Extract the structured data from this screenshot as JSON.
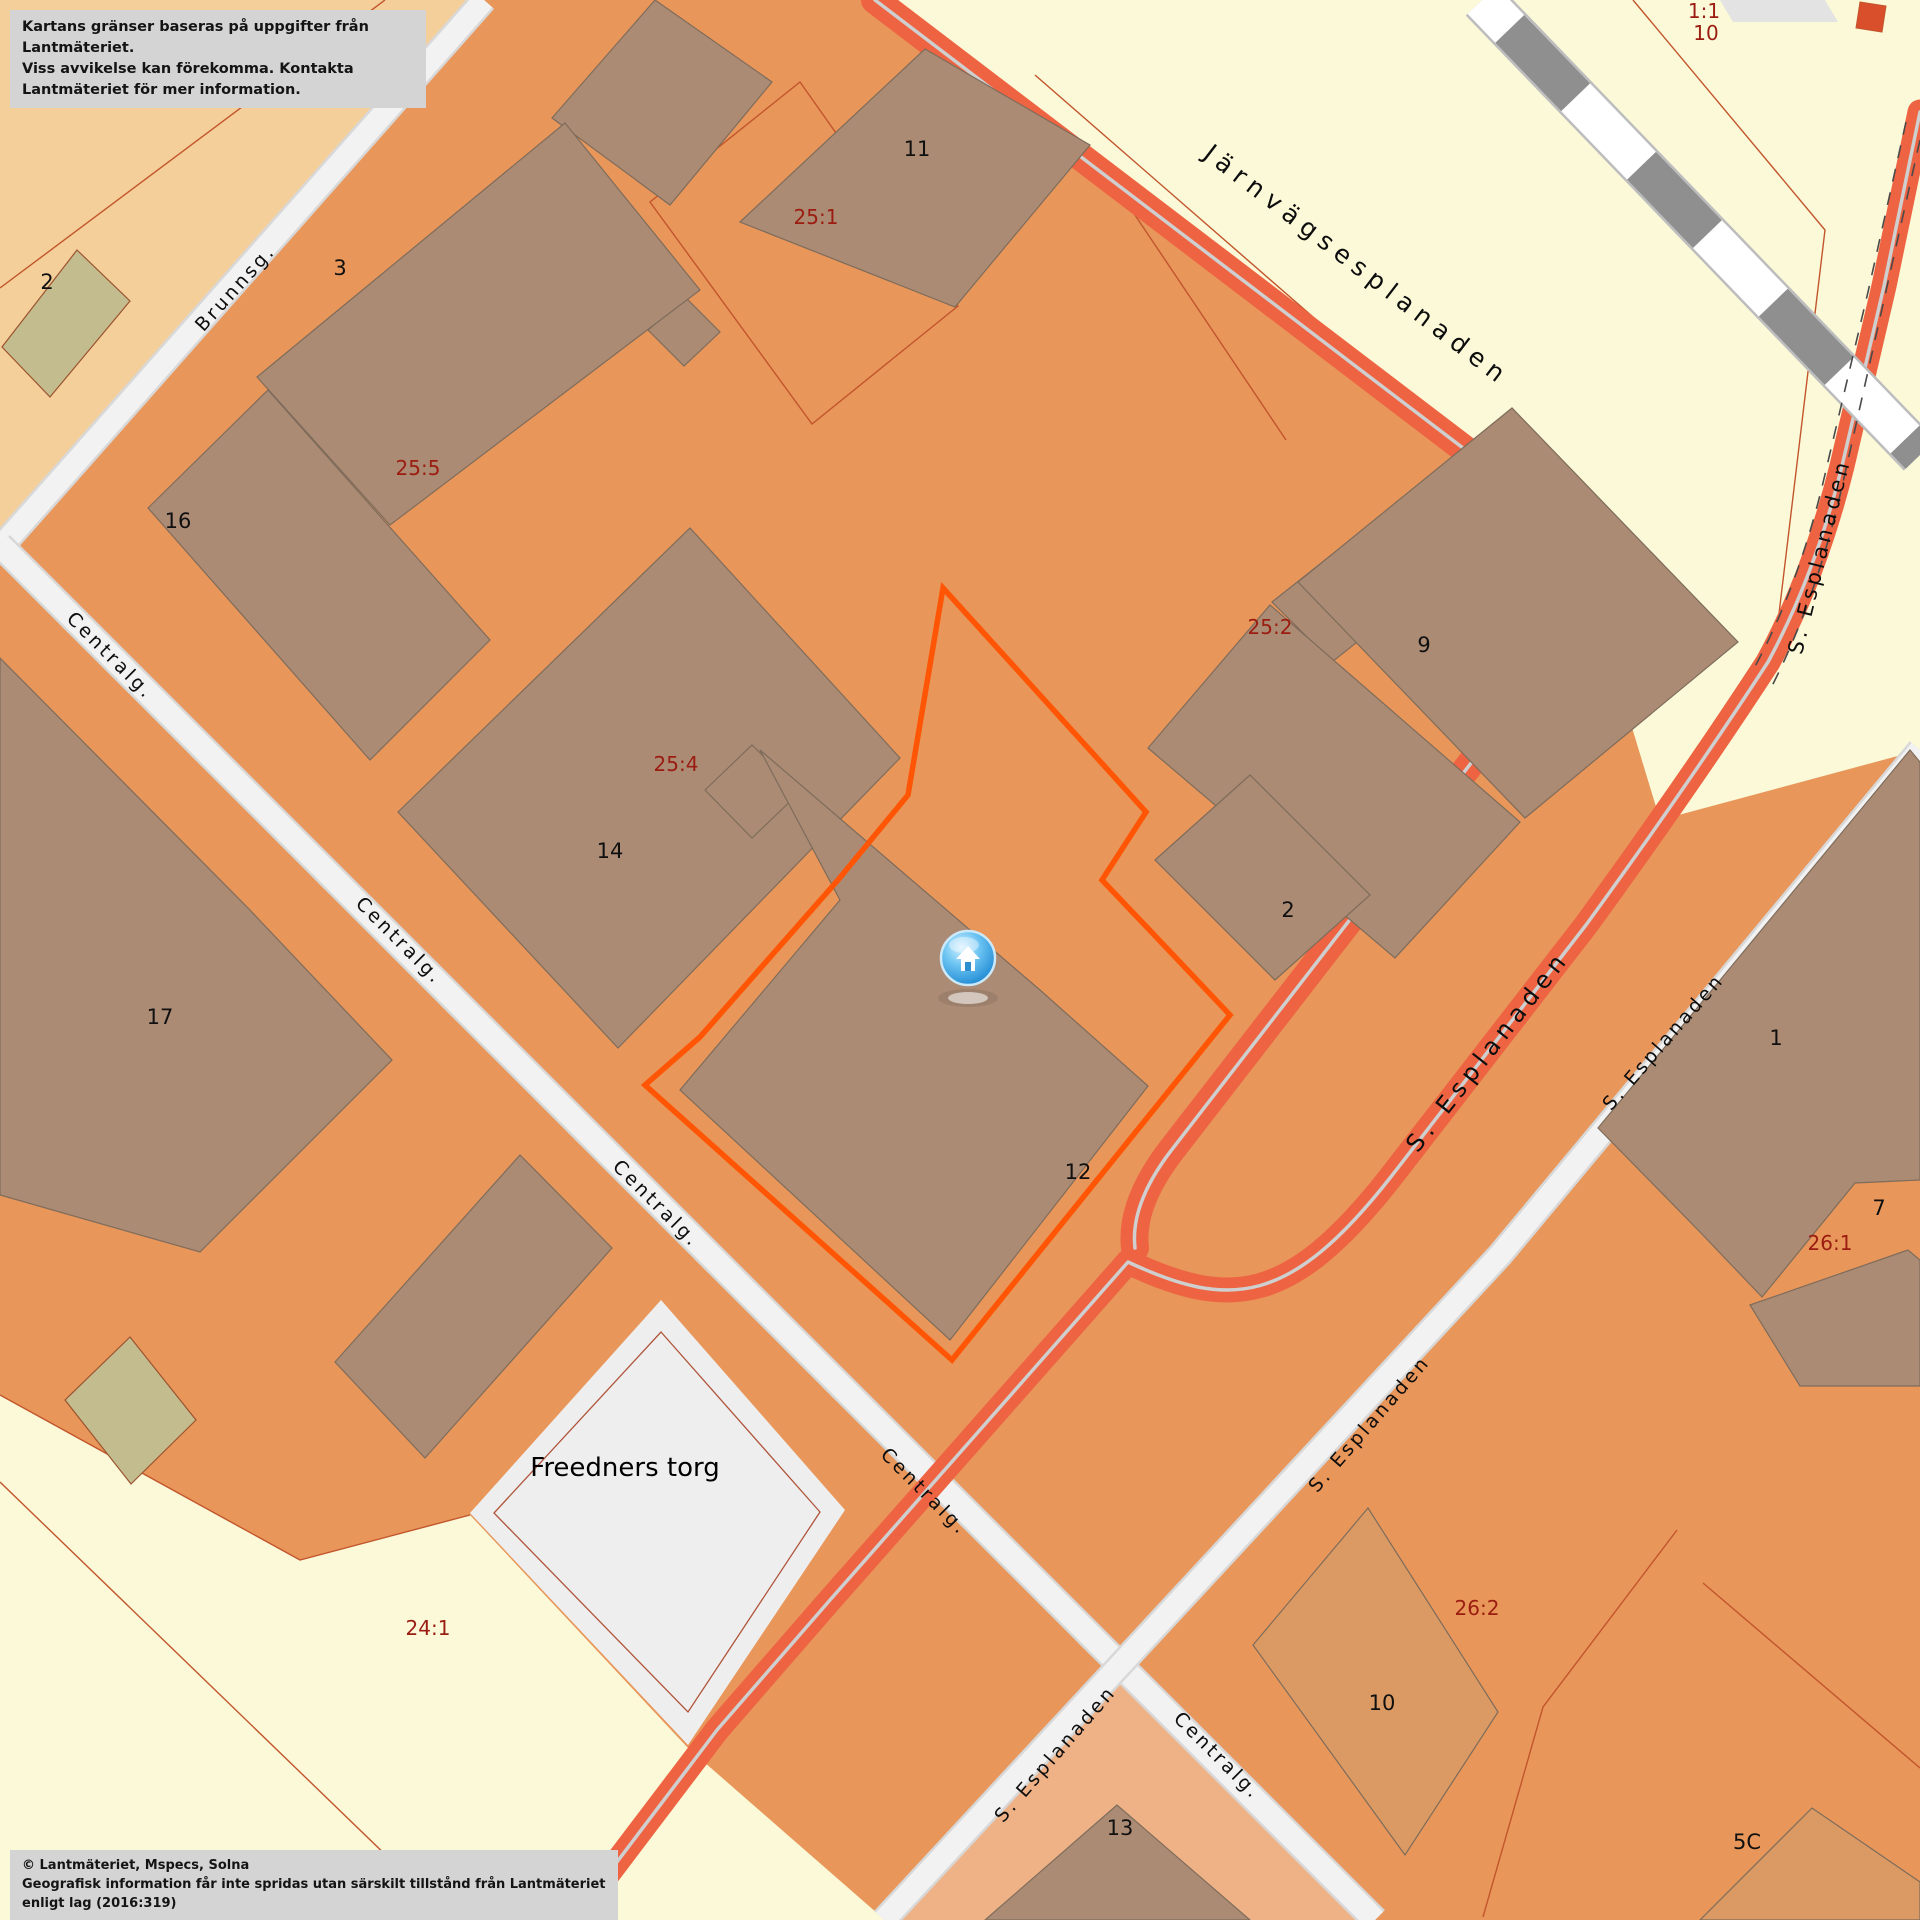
{
  "overlays": {
    "disclaimer": {
      "line1": "Kartans gränser baseras på uppgifter från Lantmäteriet.",
      "line2": "Viss avvikelse kan förekomma. Kontakta Lantmäteriet för mer information."
    },
    "attribution": {
      "line1": "© Lantmäteriet, Mspecs, Solna",
      "line2": "Geografisk information får inte spridas utan särskilt tillstånd från Lantmäteriet enligt lag (2016:319)"
    }
  },
  "streets": [
    {
      "id": "brunnsg",
      "text": "Brunnsg."
    },
    {
      "id": "centralg-1",
      "text": "Centralg."
    },
    {
      "id": "centralg-2",
      "text": "Centralg."
    },
    {
      "id": "centralg-3",
      "text": "Centralg."
    },
    {
      "id": "centralg-4",
      "text": "Centralg."
    },
    {
      "id": "centralg-5",
      "text": "Centralg."
    },
    {
      "id": "jarnvagsesplanaden",
      "text": "Järnvägsesplanaden"
    },
    {
      "id": "s-esplanaden-red-main",
      "text": "S. Esplanaden"
    },
    {
      "id": "s-esplanaden-red-edge",
      "text": "S. Esplanaden"
    },
    {
      "id": "s-esplanaden-white-mid",
      "text": "S. Esplanaden"
    },
    {
      "id": "s-esplanaden-white-lower",
      "text": "S. Esplanaden"
    },
    {
      "id": "s-esplanaden-white-bottom",
      "text": "S. Esplanaden"
    }
  ],
  "parcels": [
    {
      "id": "25-1",
      "text": "25:1"
    },
    {
      "id": "25-5",
      "text": "25:5"
    },
    {
      "id": "25-4",
      "text": "25:4"
    },
    {
      "id": "25-2",
      "text": "25:2"
    },
    {
      "id": "26-1",
      "text": "26:1"
    },
    {
      "id": "26-2",
      "text": "26:2"
    },
    {
      "id": "24-1",
      "text": "24:1"
    },
    {
      "id": "1-1",
      "text": "1:1"
    },
    {
      "id": "1-1-10",
      "text": "10"
    }
  ],
  "buildings": [
    {
      "id": "b2-topleft",
      "text": "2"
    },
    {
      "id": "b3",
      "text": "3"
    },
    {
      "id": "b16",
      "text": "16"
    },
    {
      "id": "b11",
      "text": "11"
    },
    {
      "id": "b14",
      "text": "14"
    },
    {
      "id": "b17",
      "text": "17"
    },
    {
      "id": "b9",
      "text": "9"
    },
    {
      "id": "b2-center",
      "text": "2"
    },
    {
      "id": "b12",
      "text": "12"
    },
    {
      "id": "b1",
      "text": "1"
    },
    {
      "id": "b7",
      "text": "7"
    },
    {
      "id": "b10",
      "text": "10"
    },
    {
      "id": "b13",
      "text": "13"
    },
    {
      "id": "b5c",
      "text": "5C"
    }
  ],
  "places": [
    {
      "id": "freedners-torg",
      "text": "Freedners torg"
    }
  ],
  "marker": {
    "name": "home-marker"
  },
  "colors": {
    "parcel_orange": "#E8965A",
    "parcel_pale_yellow": "#FBF9D8",
    "parcel_peach": "#F5CF9A",
    "parcel_light_orange": "#EFB286",
    "building_brown": "#AC8B74",
    "building_dark_orange": "#DB9A63",
    "building_olive": "#C3BC8E",
    "plaza_gray": "#EEEEEE",
    "road_white": "#F2F2F2",
    "road_red": "#EE6341",
    "road_centerline": "#CFCFCF",
    "highlight_orange": "#FF5505",
    "boundary_line": "#C2552C",
    "parcel_label_red": "#9B1C10",
    "railway_gray": "#8F8F8F",
    "note_box_gray": "#D4D4D4"
  }
}
